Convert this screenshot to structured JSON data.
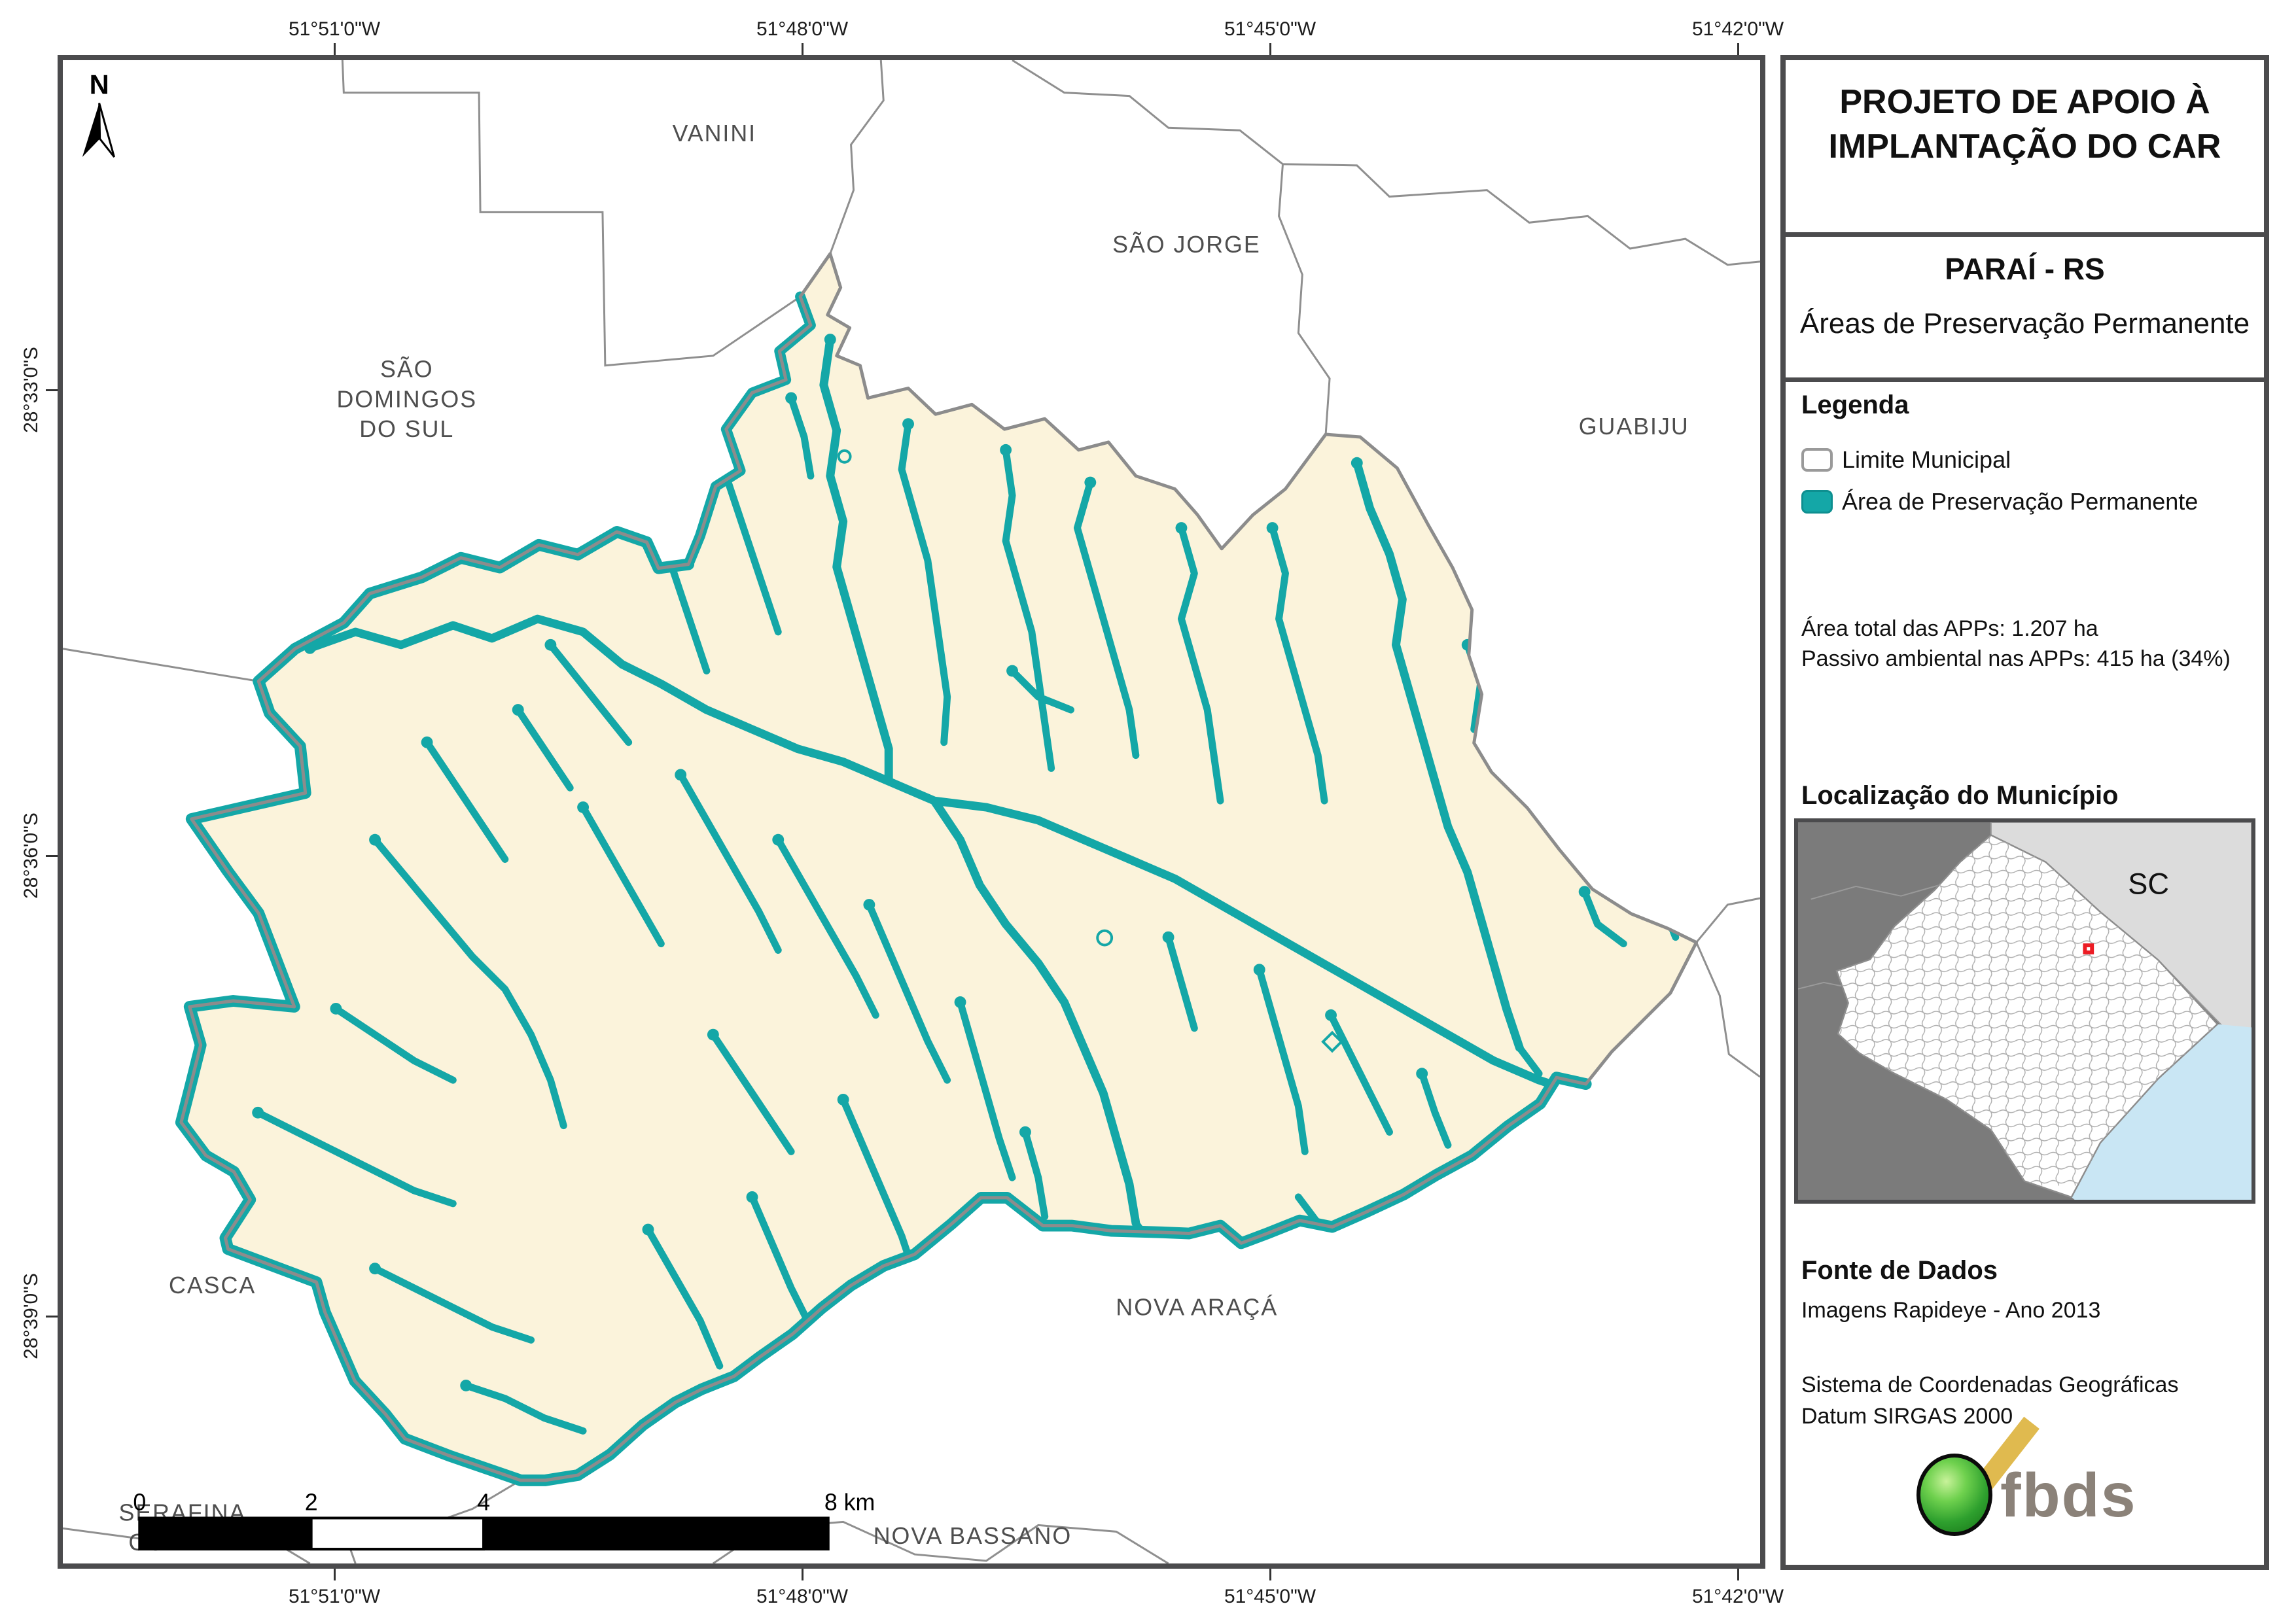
{
  "colors": {
    "app_teal": "#14A7A7",
    "municipality_fill": "#FBF3DB",
    "boundary_gray": "#8C8C8C",
    "frame_gray": "#4B4B4D",
    "map_label_gray": "#4E4E4E",
    "inset_outer_land": "#7B7B7B",
    "inset_sc_region": "#DCDCDC",
    "inset_ocean": "#C9E6F4",
    "marker_red": "#EC1C24",
    "logo_green": "#2EA02E",
    "logo_yellow": "#E0BA4F",
    "logo_text_gray": "#8B8279"
  },
  "title_block": {
    "line1": "PROJETO DE APOIO À",
    "line2": "IMPLANTAÇÃO DO CAR",
    "municipality": "PARAÍ - RS",
    "product": "Áreas de Preservação Permanente"
  },
  "legend": {
    "heading": "Legenda",
    "items": [
      {
        "label": "Limite Municipal"
      },
      {
        "label": "Área de Preservação Permanente"
      }
    ],
    "stat1": "Área total das APPs: 1.207 ha",
    "stat2": "Passivo ambiental nas APPs: 415 ha (34%)"
  },
  "location": {
    "heading": "Localização do Município",
    "state_label": "SC"
  },
  "data_source": {
    "heading": "Fonte de Dados",
    "line1": "Imagens Rapideye - Ano 2013",
    "line2": "Sistema de Coordenadas Geográficas",
    "line3": "Datum SIRGAS 2000"
  },
  "logo": {
    "text": "fbds"
  },
  "map": {
    "north_label": "N",
    "graticule": {
      "top": [
        "51°51'0\"W",
        "51°48'0\"W",
        "51°45'0\"W",
        "51°42'0\"W"
      ],
      "bottom": [
        "51°51'0\"W",
        "51°48'0\"W",
        "51°45'0\"W",
        "51°42'0\"W"
      ],
      "left": [
        "28°33'0\"S",
        "28°36'0\"S",
        "28°39'0\"S"
      ]
    },
    "neighbors": {
      "vanini": "VANINI",
      "sao_jorge": "SÃO JORGE",
      "guabiju": "GUABIJU",
      "sao_domingos_1": "SÃO",
      "sao_domingos_2": "DOMINGOS",
      "sao_domingos_3": "DO SUL",
      "casca": "CASCA",
      "nova_araca": "NOVA ARAÇÁ",
      "nova_bassano": "NOVA BASSANO",
      "serafina_1": "SERAFINA",
      "serafina_2": "CORRÊA"
    },
    "scalebar": {
      "l0": "0",
      "l2": "2",
      "l4": "4",
      "l8": "8 km"
    }
  }
}
